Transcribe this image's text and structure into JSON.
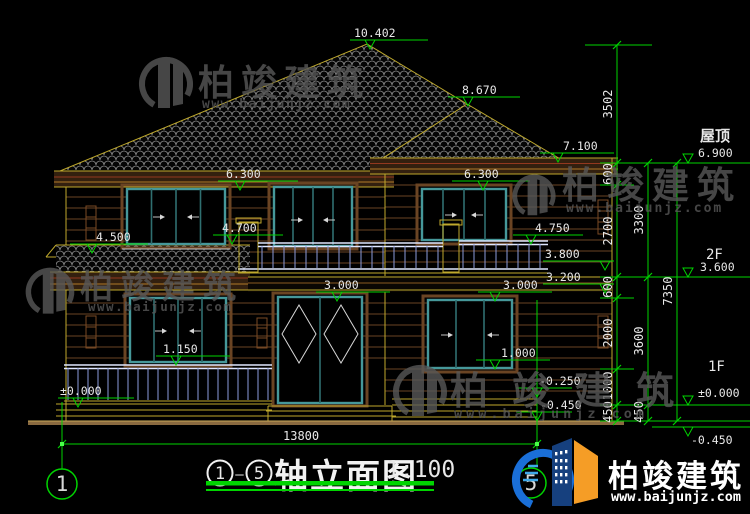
{
  "colors": {
    "green": "#00d400",
    "text": "#e8e8e8",
    "watermark": "#585858",
    "logo_blue": "#1a6fd8",
    "logo_navy": "#16407e",
    "logo_orange": "#f59d26"
  },
  "watermark": {
    "brand": "柏竣建筑",
    "url": "www.baijunjz.com"
  },
  "logo": {
    "brand": "柏竣建筑",
    "url": "www.baijunjz.com"
  },
  "title": {
    "axis_start": "1",
    "axis_end": "5",
    "separator": "—",
    "main": "轴立面图",
    "scale": "1:100"
  },
  "axes": {
    "span_dim": "13800",
    "bubbles": [
      {
        "label": "1",
        "x": 62,
        "y": 484
      },
      {
        "label": "5",
        "x": 531,
        "y": 483
      }
    ]
  },
  "side_labels": [
    {
      "t": "屋顶",
      "x": 700,
      "y": 141,
      "s": 15,
      "cjk": true
    },
    {
      "t": "2F",
      "x": 706,
      "y": 259,
      "s": 14
    },
    {
      "t": "1F",
      "x": 708,
      "y": 371,
      "s": 14
    },
    {
      "t": "13800",
      "x": 283,
      "y": 440,
      "s": 12
    }
  ],
  "vdims": [
    {
      "t": "3502",
      "x": 612,
      "y": 104
    },
    {
      "t": "600",
      "x": 612,
      "y": 174
    },
    {
      "t": "2700",
      "x": 612,
      "y": 231
    },
    {
      "t": "600",
      "x": 612,
      "y": 287
    },
    {
      "t": "2000",
      "x": 612,
      "y": 333
    },
    {
      "t": "1000",
      "x": 612,
      "y": 386
    },
    {
      "t": "450",
      "x": 612,
      "y": 412
    },
    {
      "t": "3300",
      "x": 643,
      "y": 220
    },
    {
      "t": "3600",
      "x": 643,
      "y": 341
    },
    {
      "t": "450",
      "x": 643,
      "y": 412
    },
    {
      "t": "7350",
      "x": 672,
      "y": 291
    }
  ],
  "markers": [
    {
      "t": "10.402",
      "l": [
        350,
        428,
        40
      ],
      "tp": [
        370,
        49
      ],
      "tx": [
        354,
        37
      ]
    },
    {
      "t": "8.670",
      "l": [
        448,
        520,
        97
      ],
      "tp": [
        468,
        106
      ],
      "tx": [
        462,
        94
      ]
    },
    {
      "t": "7.100",
      "l": [
        540,
        614,
        153
      ],
      "tp": [
        558,
        162
      ],
      "tx": [
        563,
        150
      ]
    },
    {
      "t": "6.300",
      "l": [
        218,
        298,
        181
      ],
      "tp": [
        240,
        190
      ],
      "tx": [
        226,
        178
      ]
    },
    {
      "t": "6.300",
      "l": [
        452,
        530,
        181
      ],
      "tp": [
        483,
        190
      ],
      "tx": [
        464,
        178
      ]
    },
    {
      "t": "4.500",
      "l": [
        70,
        148,
        244
      ],
      "tp": [
        92,
        253
      ],
      "tx": [
        96,
        241
      ]
    },
    {
      "t": "4.700",
      "l": [
        213,
        283,
        235
      ],
      "tp": [
        232,
        244
      ],
      "tx": [
        222,
        232
      ]
    },
    {
      "t": "4.750",
      "l": [
        513,
        583,
        235
      ],
      "tp": [
        531,
        244
      ],
      "tx": [
        535,
        232
      ]
    },
    {
      "t": "3.800",
      "l": [
        543,
        614,
        261
      ],
      "tp": [
        605,
        270
      ],
      "tx": [
        545,
        258
      ]
    },
    {
      "t": "3.200",
      "l": [
        543,
        614,
        284
      ],
      "tp": [
        605,
        293
      ],
      "tx": [
        546,
        281
      ]
    },
    {
      "t": "3.000",
      "l": [
        316,
        390,
        292
      ],
      "tp": [
        337,
        301
      ],
      "tx": [
        324,
        289
      ]
    },
    {
      "t": "3.000",
      "l": [
        478,
        552,
        292
      ],
      "tp": [
        495,
        301
      ],
      "tx": [
        503,
        289
      ]
    },
    {
      "t": "1.150",
      "l": [
        156,
        230,
        356
      ],
      "tp": [
        176,
        365
      ],
      "tx": [
        163,
        353
      ]
    },
    {
      "t": "1.000",
      "l": [
        476,
        550,
        360
      ],
      "tp": [
        495,
        369
      ],
      "tx": [
        501,
        357
      ]
    },
    {
      "t": "±0.000",
      "l": [
        58,
        134,
        398
      ],
      "tp": [
        78,
        407
      ],
      "tx": [
        60,
        395
      ]
    },
    {
      "t": "-0.250",
      "l": [
        516,
        572,
        388
      ],
      "tp": [
        537,
        397
      ],
      "tx": [
        539,
        385
      ]
    },
    {
      "t": "-0.450",
      "l": [
        516,
        572,
        412
      ],
      "tp": [
        537,
        421
      ],
      "tx": [
        540,
        409
      ]
    },
    {
      "t": "6.900",
      "l": [
        640,
        750,
        163
      ],
      "tp": [
        688,
        163
      ],
      "tx": [
        698,
        157
      ]
    },
    {
      "t": "3.600",
      "l": [
        640,
        750,
        277
      ],
      "tp": [
        688,
        277
      ],
      "tx": [
        700,
        271
      ]
    },
    {
      "t": "±0.000",
      "l": [
        640,
        750,
        405
      ],
      "tp": [
        688,
        405
      ],
      "tx": [
        698,
        397
      ]
    },
    {
      "t": "-0.450",
      "l": [
        652,
        750,
        427
      ],
      "tp": [
        688,
        436
      ],
      "tx": [
        691,
        444
      ]
    }
  ]
}
